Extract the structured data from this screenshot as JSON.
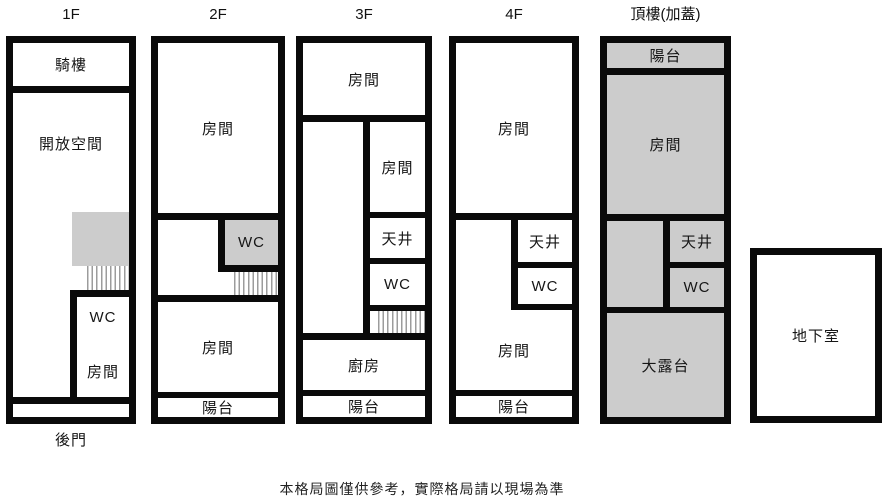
{
  "caption": "本格局圖僅供參考，實際格局請以現場為準",
  "colors": {
    "wall": "#0a0a0a",
    "room_fill": "#cccccc",
    "stair_line": "#9c9c9c"
  },
  "floors": {
    "f1": {
      "title": "1F",
      "arcade": "騎樓",
      "open_space": "開放空間",
      "wc": "WC",
      "room": "房間",
      "back_door": "後門"
    },
    "f2": {
      "title": "2F",
      "room_top": "房間",
      "wc": "WC",
      "room_bottom": "房間",
      "balcony": "陽台"
    },
    "f3": {
      "title": "3F",
      "room_top": "房間",
      "room_mid": "房間",
      "lightwell": "天井",
      "wc": "WC",
      "kitchen": "廚房",
      "balcony": "陽台"
    },
    "f4": {
      "title": "4F",
      "room_top": "房間",
      "lightwell": "天井",
      "wc": "WC",
      "room_bottom": "房間",
      "balcony": "陽台"
    },
    "roof": {
      "title": "頂樓(加蓋)",
      "balcony": "陽台",
      "room": "房間",
      "lightwell": "天井",
      "wc": "WC",
      "terrace": "大露台"
    },
    "basement": {
      "label": "地下室"
    }
  }
}
